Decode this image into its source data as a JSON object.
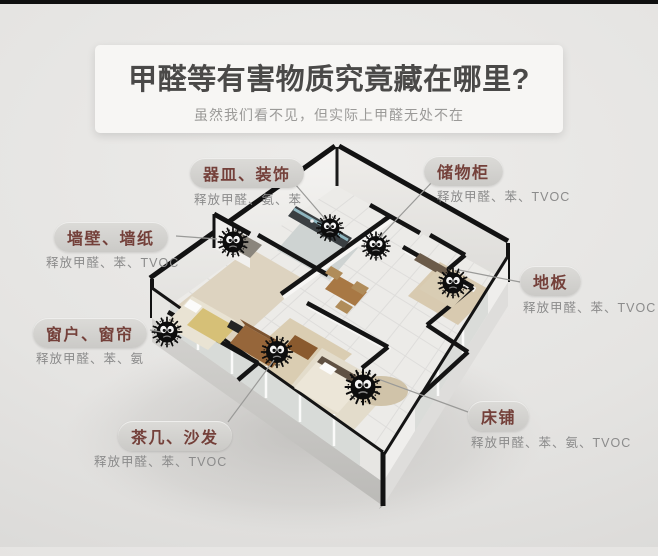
{
  "header": {
    "title": "甲醛等有害物质究竟藏在哪里?",
    "subtitle": "虽然我们看不见，但实际上甲醛无处不在"
  },
  "callouts": [
    {
      "label": "器皿、装饰",
      "release": "释放甲醛、氨、苯"
    },
    {
      "label": "储物柜",
      "release": "释放甲醛、苯、TVOC"
    },
    {
      "label": "墙壁、墙纸",
      "release": "释放甲醛、苯、TVOC"
    },
    {
      "label": "地板",
      "release": "释放甲醛、苯、TVOC"
    },
    {
      "label": "窗户、窗帘",
      "release": "释放甲醛、苯、氨"
    },
    {
      "label": "茶几、沙发",
      "release": "释放甲醛、苯、TVOC"
    },
    {
      "label": "床铺",
      "release": "释放甲醛、苯、氨、TVOC"
    }
  ],
  "illustration": {
    "description": "isometric-3d-apartment-floorplan",
    "germ_icon": "black-fuzzy-germ-ball-with-eyes",
    "germ_count": 7
  },
  "colors": {
    "page_bg": "#e5e4e2",
    "card_bg": "#f7f6f4",
    "title_text": "#4a4948",
    "subtitle_text": "#9b9a98",
    "pill_bg": "#d3d2cf",
    "pill_text": "#74403a",
    "release_text": "#8b8b8b",
    "top_bar": "#0f0f0f"
  }
}
